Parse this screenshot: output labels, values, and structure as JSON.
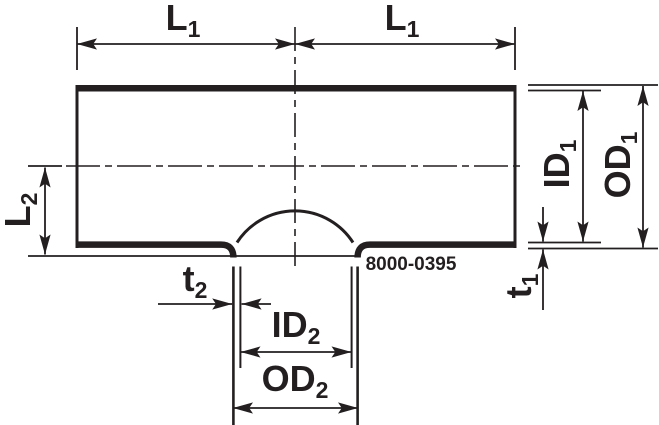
{
  "part_number": "8000-0395",
  "labels": {
    "l1_left": {
      "base": "L",
      "sub": "1"
    },
    "l1_right": {
      "base": "L",
      "sub": "1"
    },
    "l2": {
      "base": "L",
      "sub": "2"
    },
    "id1": {
      "base": "ID",
      "sub": "1"
    },
    "od1": {
      "base": "OD",
      "sub": "1"
    },
    "t1": {
      "base": "t",
      "sub": "1"
    },
    "t2": {
      "base": "t",
      "sub": "2"
    },
    "id2": {
      "base": "ID",
      "sub": "2"
    },
    "od2": {
      "base": "OD",
      "sub": "2"
    }
  },
  "colors": {
    "line": "#231f20",
    "background": "#ffffff"
  }
}
